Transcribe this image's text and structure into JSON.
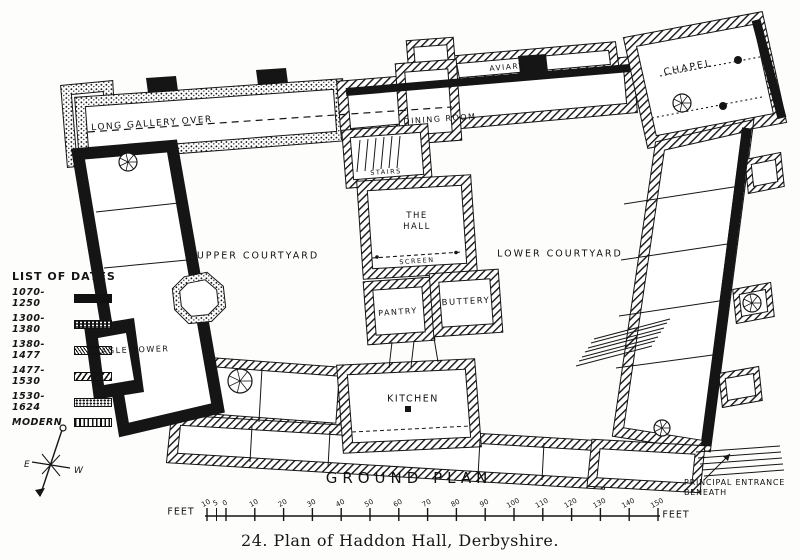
{
  "figure": {
    "caption": "24.  Plan of Haddon Hall, Derbyshire.",
    "plan_title": "GROUND  PLAN"
  },
  "legend": {
    "title": "LIST OF DATES",
    "entries": [
      {
        "label": "1070-1250",
        "pattern": "solid-black"
      },
      {
        "label": "1300-1380",
        "pattern": "black-speckled"
      },
      {
        "label": "1380-1477",
        "pattern": "fine-diagonal-hatch"
      },
      {
        "label": "1477-1530",
        "pattern": "diagonal-lines"
      },
      {
        "label": "1530-1624",
        "pattern": "stipple"
      },
      {
        "label": "MODERN",
        "pattern": "vertical-lines"
      }
    ]
  },
  "rooms": {
    "long_gallery": "LONG GALLERY OVER",
    "aviary": "AVIARY",
    "chapel": "CHAPEL",
    "dining_room": "DINING ROOM",
    "stairs": "STAIRS",
    "hall_line1": "THE",
    "hall_line2": "HALL",
    "screen": "SCREEN",
    "upper_courtyard": "UPPER  COURTYARD",
    "lower_courtyard": "LOWER  COURTYARD",
    "eagle_tower": "EAGLE TOWER",
    "pantry": "PANTRY",
    "buttery": "BUTTERY",
    "kitchen": "KITCHEN"
  },
  "annotations": {
    "principal_entrance_line1": "PRINCIPAL ENTRANCE",
    "principal_entrance_line2": "BENEATH"
  },
  "compass": {
    "east": "E",
    "west": "W"
  },
  "scale_bar": {
    "unit_left": "FEET",
    "unit_right": "FEET",
    "ticks": [
      "10",
      "5",
      "0",
      "10",
      "20",
      "30",
      "40",
      "50",
      "60",
      "70",
      "80",
      "90",
      "100",
      "110",
      "120",
      "130",
      "140",
      "150"
    ]
  },
  "colors": {
    "ink": "#151515",
    "paper": "#fdfdfc"
  }
}
